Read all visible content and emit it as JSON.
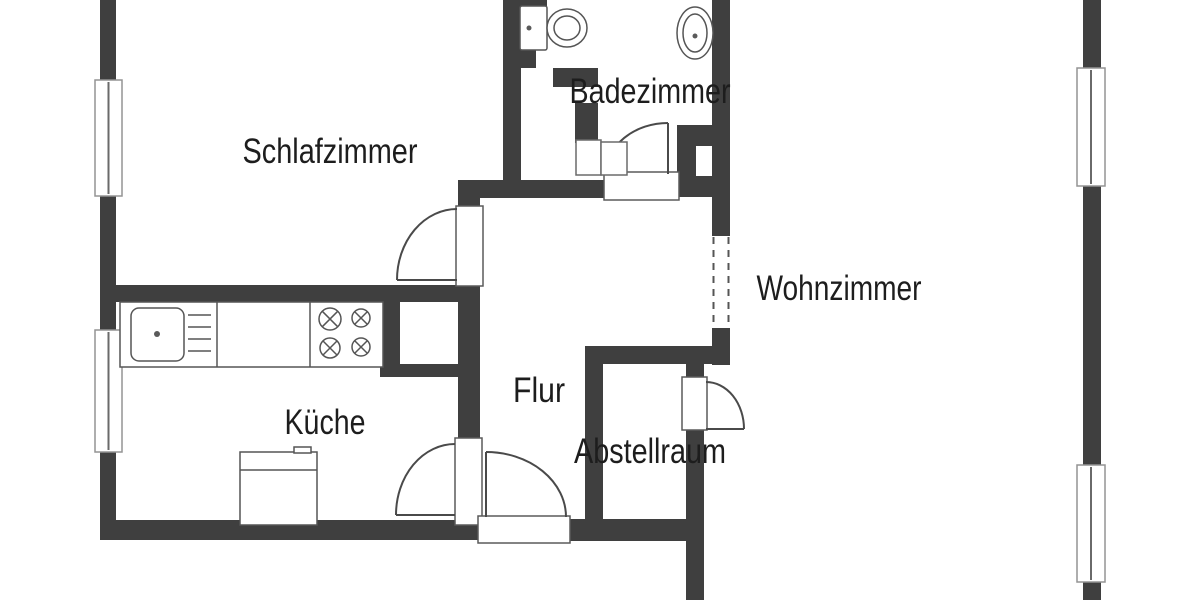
{
  "page": {
    "type": "floor-plan",
    "language": "de",
    "background": "#ffffff"
  },
  "palette": {
    "wall": "#3f3f3f",
    "fixture_outline": "#555555",
    "door_outline": "#5a5a5a",
    "door_arc": "#4a4a4a",
    "window_outline": "#949494",
    "window_mullion": "#6a6a6a",
    "label_text": "#1d1d1d"
  },
  "rooms": [
    {
      "id": "schlafzimmer",
      "label": "Schlafzimmer"
    },
    {
      "id": "badezimmer",
      "label": "Badezimmer"
    },
    {
      "id": "wohnzimmer",
      "label": "Wohnzimmer"
    },
    {
      "id": "flur",
      "label": "Flur"
    },
    {
      "id": "kueche",
      "label": "Küche"
    },
    {
      "id": "abstellraum",
      "label": "Abstellraum"
    }
  ],
  "fixtures": [
    "toilet",
    "washbasin",
    "bathroom-cabinet",
    "kitchen-counter",
    "kitchen-sink",
    "faucet",
    "drawer-unit",
    "cooktop-four-burners",
    "kitchen-appliance",
    "wall-shaft",
    "wall-niche"
  ],
  "doors": [
    "bedroom-door",
    "bathroom-door",
    "kitchen-door",
    "entrance-door",
    "storage-room-door",
    "living-room-passage"
  ],
  "windows": {
    "left_wall": 2,
    "right_wall": 2
  }
}
